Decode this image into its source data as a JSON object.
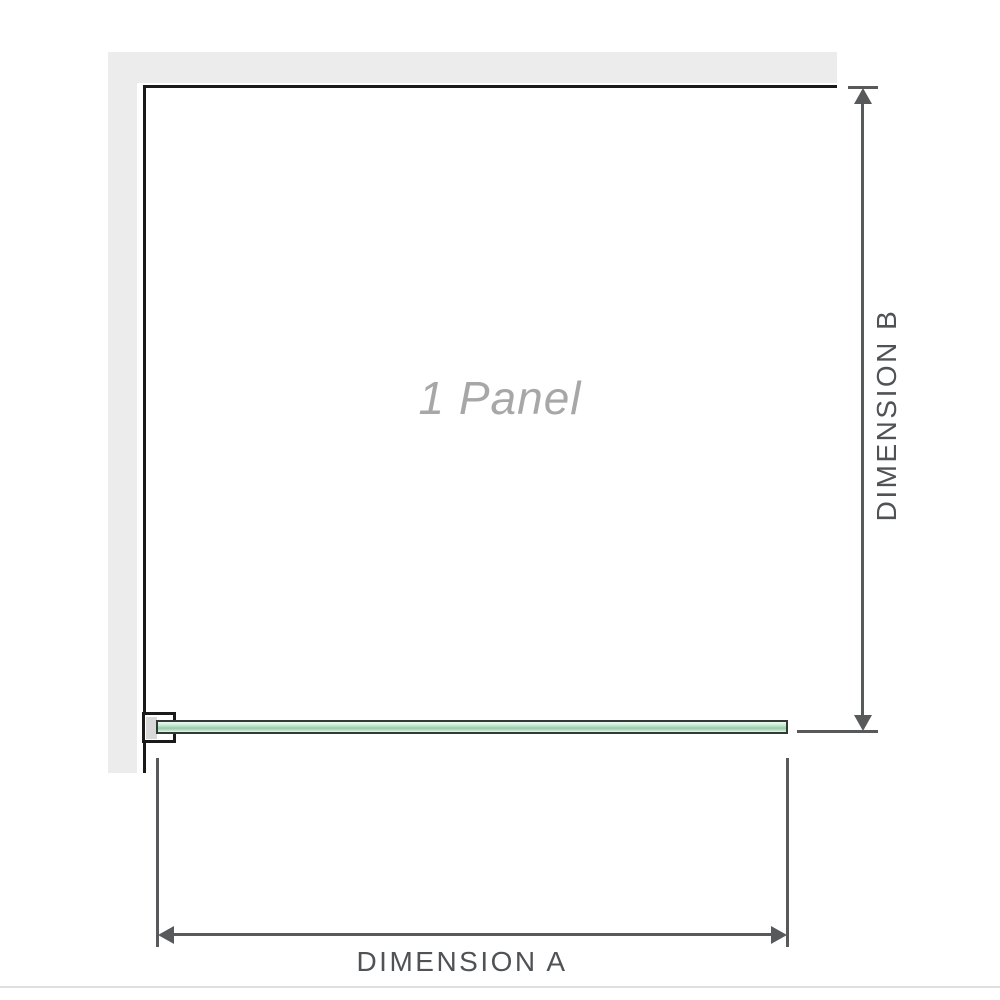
{
  "diagram": {
    "title": "1 panel shower screen dimension diagram",
    "panel_label": "1 Panel",
    "dimension_a_label": "DIMENSION A",
    "dimension_b_label": "DIMENSION B"
  },
  "colors": {
    "bg": "#ffffff",
    "wall": "#ececec",
    "frame": "#1a1a1a",
    "dim-line": "#58595b",
    "dim-text": "#4f5356",
    "panel-text": "#a7a7a8",
    "glass-border": "#2f3b33",
    "glass-light": "#e9f5ee",
    "glass-mid": "#92cda3",
    "bracket-fill": "#d8d8d8",
    "rule": "#dfdfdf"
  }
}
